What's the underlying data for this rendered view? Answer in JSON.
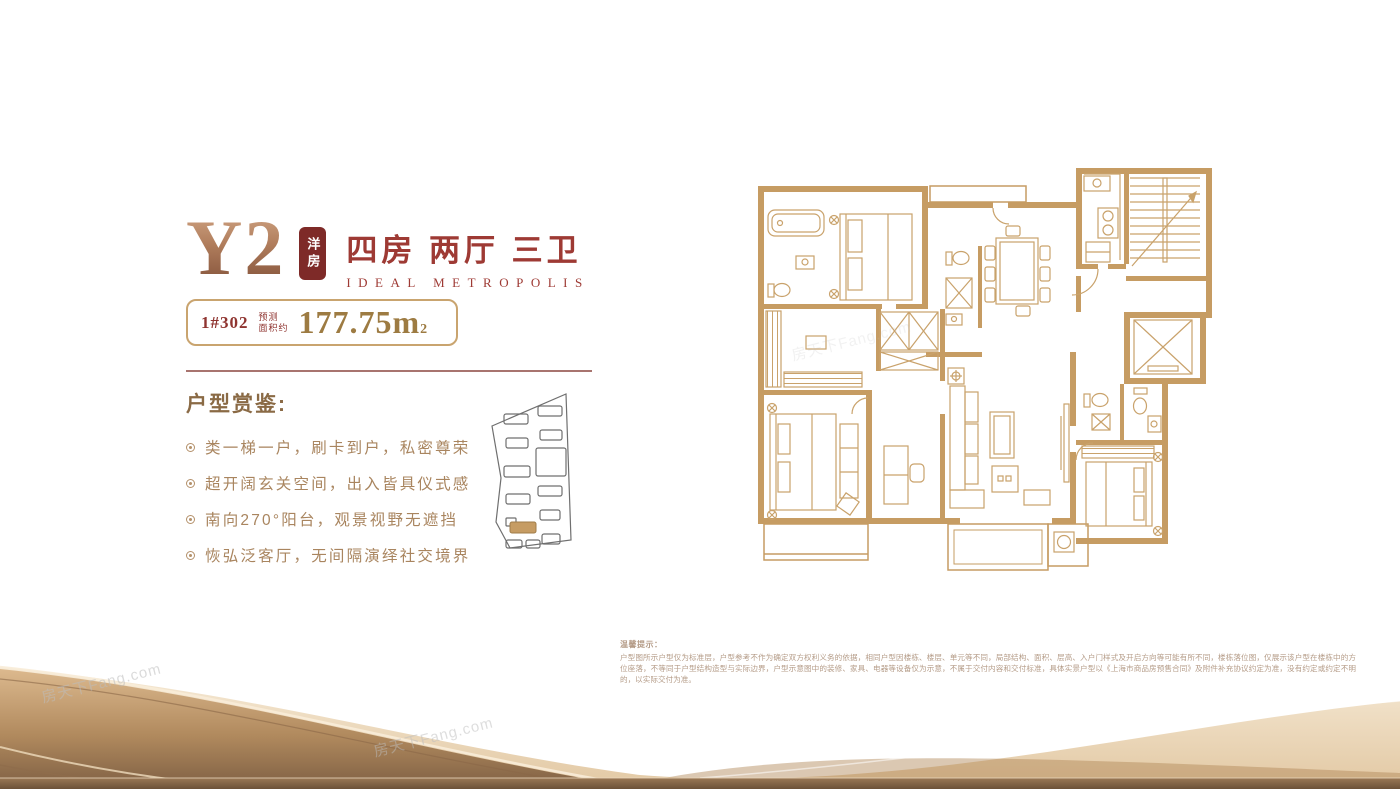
{
  "header": {
    "plan_code": "Y2",
    "badge": "洋房",
    "title": "四房 两厅 三卫",
    "subtitle": "IDEAL METROPOLIS",
    "unit_label": "1#302",
    "area_prefix_line1": "预测",
    "area_prefix_line2": "面积约",
    "area_value": "177.75",
    "area_unit": "m",
    "area_sup": "2"
  },
  "highlights": {
    "heading": "户型赏鉴:",
    "items": [
      "类一梯一户，刷卡到户，私密尊荣",
      "超开阔玄关空间，出入皆具仪式感",
      "南向270°阳台，观景视野无遮挡",
      "恢弘泛客厅，无间隔演绎社交境界"
    ]
  },
  "disclaimer": {
    "title": "温馨提示：",
    "body": "户型图所示户型仅为标准层，户型参考不作为确定双方权利义务的依据，相同户型因楼栋、楼层、单元等不同，局部结构、面积、层高、入户门样式及开启方向等可能有所不同，楼栋落位图，仅展示该户型在楼栋中的方位座落，不等同于户型结构造型与实际边界，户型示意图中的装修、家具、电器等设备仅为示意，不属于交付内容和交付标准，具体实景户型以《上海市商品房预售合同》及附件补充协议约定为准，没有约定或约定不明的，以实际交付为准。"
  },
  "watermark": {
    "text": "房天下Fang.com"
  },
  "colors": {
    "accent_red": "#9e3a34",
    "badge_bg": "#7e2a28",
    "gold_text": "#9d7b42",
    "brown_text": "#a9855f",
    "plan_wall": "#c69c63",
    "plan_furniture": "#c9a26b",
    "rule": "#a8746f",
    "wave_gold": "#c89a67"
  }
}
